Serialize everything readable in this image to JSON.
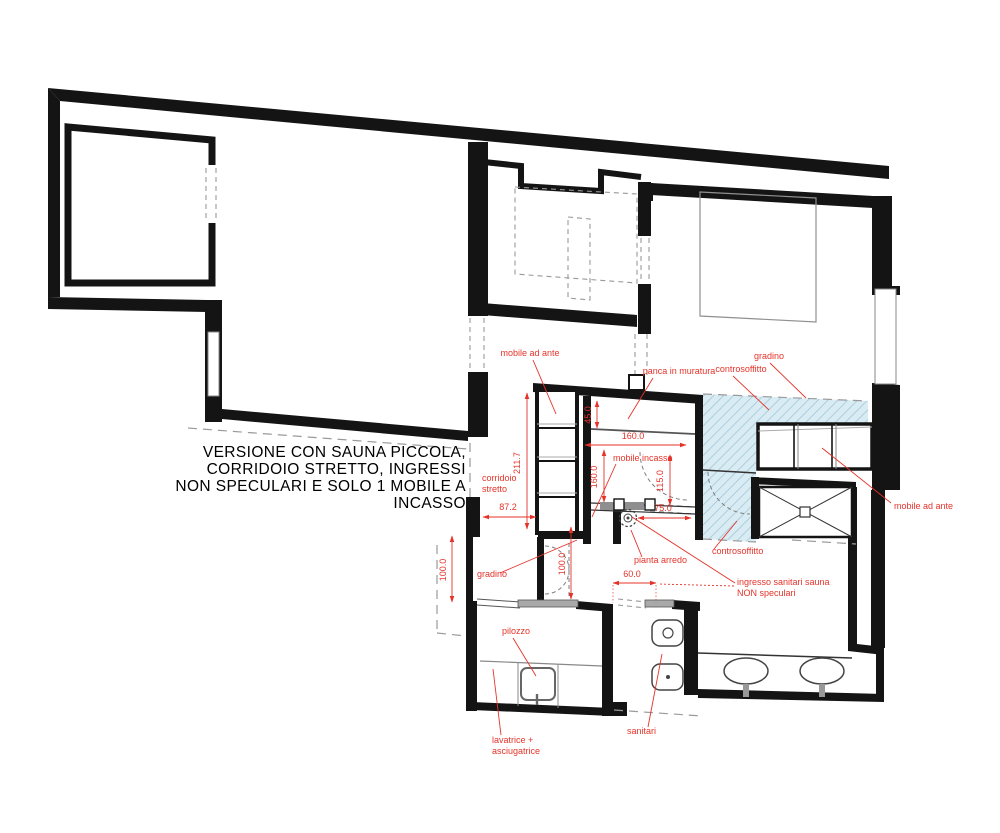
{
  "title": {
    "lines": [
      "VERSIONE CON SAUNA PICCOLA,",
      "CORRIDOIO STRETTO, INGRESSI",
      "NON SPECULARI E SOLO 1 MOBILE A",
      "INCASSO"
    ]
  },
  "colors": {
    "annotation": "#e5332a",
    "walls": "#141414",
    "hatch_fill": "#d9ebf3",
    "hatch_line": "#9cc3d4",
    "dashed_gray": "#999999"
  },
  "annotations": {
    "labels": [
      {
        "text": "mobile ad ante",
        "x": 530,
        "y": 356,
        "a": "middle"
      },
      {
        "text": "panca in muratura",
        "x": 679,
        "y": 374,
        "a": "middle"
      },
      {
        "text": "controsoffitto",
        "x": 741,
        "y": 372,
        "a": "middle"
      },
      {
        "text": "gradino",
        "x": 769,
        "y": 359,
        "a": "middle"
      },
      {
        "text": "mobile ad ante",
        "x": 894,
        "y": 509,
        "a": "start"
      },
      {
        "text": "controsoffitto",
        "x": 712,
        "y": 554,
        "a": "start"
      },
      {
        "text": "gradino",
        "x": 477,
        "y": 577,
        "a": "start"
      },
      {
        "text": "pianta arredo",
        "x": 634,
        "y": 563,
        "a": "start"
      },
      {
        "text": "ingresso sanitari sauna",
        "x": 737,
        "y": 585,
        "a": "start"
      },
      {
        "text": "NON speculari",
        "x": 737,
        "y": 596,
        "a": "start"
      },
      {
        "text": "pilozzo",
        "x": 502,
        "y": 634,
        "a": "start"
      },
      {
        "text": "lavatrice +",
        "x": 492,
        "y": 743,
        "a": "start"
      },
      {
        "text": "asciugatrice",
        "x": 492,
        "y": 754,
        "a": "start"
      },
      {
        "text": "sanitari",
        "x": 627,
        "y": 734,
        "a": "start"
      },
      {
        "text": "corridoio",
        "x": 482,
        "y": 481,
        "a": "start"
      },
      {
        "text": "stretto",
        "x": 482,
        "y": 492,
        "a": "start"
      },
      {
        "text": "mobile incasso",
        "x": 613,
        "y": 461,
        "a": "start"
      }
    ],
    "leaders": [
      [
        533,
        360,
        556,
        414
      ],
      [
        653,
        378,
        628,
        419
      ],
      [
        733,
        376,
        769,
        410
      ],
      [
        770,
        363,
        806,
        398
      ],
      [
        891,
        503,
        822,
        448
      ],
      [
        714,
        549,
        737,
        521
      ],
      [
        500,
        573,
        577,
        540
      ],
      [
        642,
        557,
        631,
        530
      ],
      [
        735,
        583,
        632,
        517
      ],
      [
        513,
        638,
        536,
        676
      ],
      [
        501,
        735,
        493,
        669
      ],
      [
        648,
        727,
        662,
        654
      ],
      [
        616,
        464,
        592,
        517
      ]
    ],
    "leaders_dashed": [
      [
        734,
        586,
        658,
        584
      ]
    ],
    "dims": [
      {
        "text": "211.7",
        "x": 520,
        "y": 463,
        "rot": -90,
        "line": [
          527,
          393,
          527,
          529
        ]
      },
      {
        "text": "45.0",
        "x": 591,
        "y": 415,
        "rot": -90,
        "line": [
          597,
          401,
          597,
          428
        ]
      },
      {
        "text": "160.0",
        "x": 633,
        "y": 439,
        "rot": 0,
        "line": [
          585,
          445,
          686,
          445
        ]
      },
      {
        "text": "160.0",
        "x": 597,
        "y": 477,
        "rot": -90,
        "line": [
          604,
          450,
          604,
          502
        ]
      },
      {
        "text": "115.0",
        "x": 663,
        "y": 481,
        "rot": -90,
        "line": [
          670,
          455,
          670,
          505
        ]
      },
      {
        "text": "87.2",
        "x": 508,
        "y": 510,
        "rot": 0,
        "line": [
          483,
          517,
          536,
          517
        ]
      },
      {
        "text": "75.0",
        "x": 663,
        "y": 511,
        "rot": 0,
        "line": [
          638,
          518,
          691,
          518
        ]
      },
      {
        "text": "100.0",
        "x": 446,
        "y": 570,
        "rot": -90,
        "line": [
          452,
          536,
          452,
          602
        ]
      },
      {
        "text": "100.0",
        "x": 565,
        "y": 564,
        "rot": -90,
        "line": [
          571,
          527,
          571,
          599
        ]
      },
      {
        "text": "60.0",
        "x": 632,
        "y": 577,
        "rot": 0,
        "line": [
          613,
          583,
          656,
          583
        ]
      }
    ],
    "dotted": [
      [
        613,
        585,
        613,
        603
      ],
      [
        656,
        585,
        656,
        603
      ]
    ]
  }
}
